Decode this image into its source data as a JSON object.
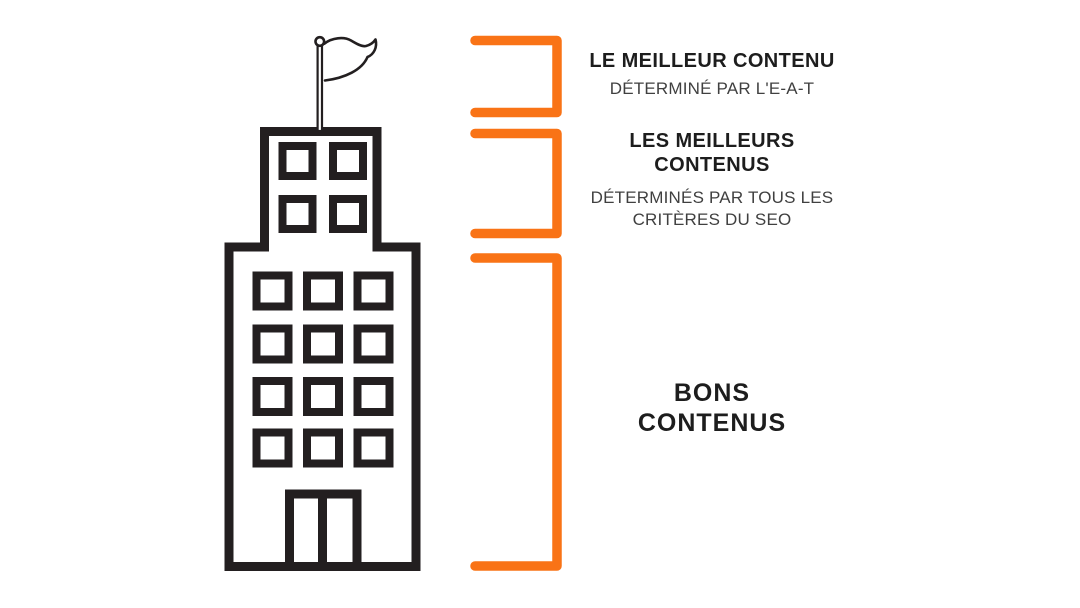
{
  "meta": {
    "description": "SEO content hierarchy infographic: building with flag, three orange brackets labelling content quality tiers",
    "language": "fr"
  },
  "palette": {
    "accent": "#F97316",
    "ink": "#231F20",
    "title": "#1D1D1D",
    "subtitle": "#404040",
    "bg": "#FFFFFF"
  },
  "illustration": {
    "icons": [
      "building-icon",
      "flag-icon",
      "top-bracket-icon",
      "middle-bracket-icon",
      "bottom-bracket-icon"
    ]
  },
  "sections": [
    {
      "id": "top",
      "title_lines": [
        "LE MEILLEUR CONTENU"
      ],
      "subtitle_lines": [
        "DÉTERMINÉ PAR L'E-A-T"
      ]
    },
    {
      "id": "middle",
      "title_lines": [
        "LES MEILLEURS",
        "CONTENUS"
      ],
      "subtitle_lines": [
        "DÉTERMINÉS PAR TOUS LES",
        "CRITÈRES DU SEO"
      ]
    },
    {
      "id": "bottom",
      "title_lines": [
        "BONS",
        "CONTENUS"
      ],
      "subtitle_lines": []
    }
  ]
}
